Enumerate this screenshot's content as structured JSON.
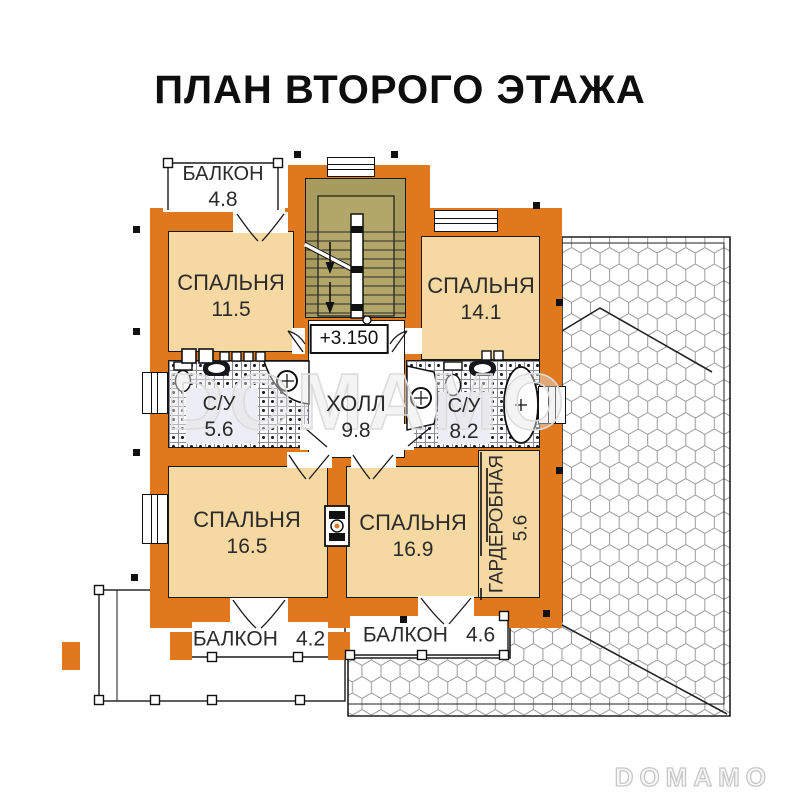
{
  "title": "ПЛАН ВТОРОГО ЭТАЖА",
  "elevation": "+3.150",
  "watermark": {
    "plan_overlay": "DOMAMO",
    "brand": "DOMAMO"
  },
  "rooms": {
    "balcony_top": {
      "name": "БАЛКОН",
      "area": "4.8"
    },
    "bedroom_top_left": {
      "name": "СПАЛЬНЯ",
      "area": "11.5"
    },
    "bedroom_top_right": {
      "name": "СПАЛЬНЯ",
      "area": "14.1"
    },
    "bathroom_left": {
      "name": "С/У",
      "area": "5.6"
    },
    "hall": {
      "name": "ХОЛЛ",
      "area": "9.8"
    },
    "bathroom_right": {
      "name": "С/У",
      "area": "8.2"
    },
    "bedroom_bottom_left": {
      "name": "СПАЛЬНЯ",
      "area": "16.5"
    },
    "bedroom_bottom_right": {
      "name": "СПАЛЬНЯ",
      "area": "16.9"
    },
    "wardrobe": {
      "name": "ГАРДЕРОБНАЯ",
      "area": "5.6"
    },
    "balcony_bottom_left": {
      "name": "БАЛКОН",
      "area": "4.2"
    },
    "balcony_bottom_right": {
      "name": "БАЛКОН",
      "area": "4.6"
    }
  },
  "colors": {
    "wall": "#E0791E",
    "floor": "#F6D8A2",
    "stairs": "#A89B5E",
    "stairs_inner": "#B3A669",
    "outline": "#1A1A1A",
    "roof_line": "#9A9A9A",
    "watermark": "#DCDCDC"
  }
}
